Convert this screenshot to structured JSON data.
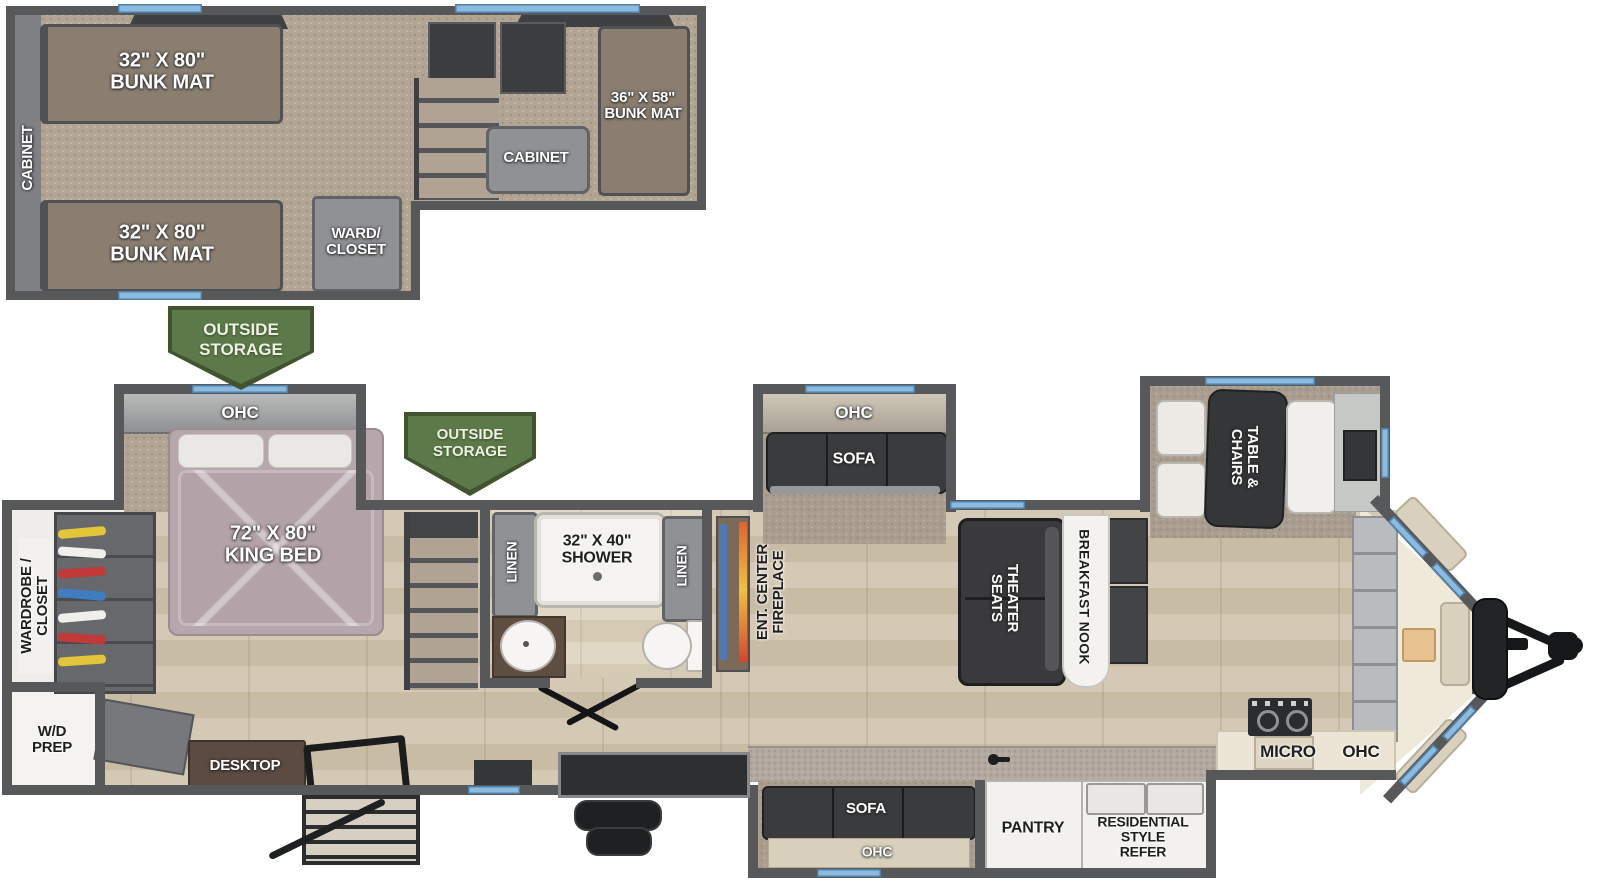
{
  "plan_title": "Travel trailer floor plan",
  "loft": {
    "side_cabinet": "CABINET",
    "bunk_top": "32\" X 80\"\nBUNK MAT",
    "bunk_bottom": "32\" X 80\"\nBUNK MAT",
    "ward_closet": "WARD/\nCLOSET",
    "cabinet": "CABINET",
    "bunk_right": "36\" X 58\"\nBUNK MAT"
  },
  "banners": {
    "storage_rear": "OUTSIDE\nSTORAGE",
    "storage_mid": "OUTSIDE\nSTORAGE"
  },
  "bedroom": {
    "ohc": "OHC",
    "king_bed": "72\" X 80\"\nKING BED",
    "wardrobe": "WARDROBE /\nCLOSET",
    "wd_prep": "W/D\nPREP",
    "desktop": "DESKTOP"
  },
  "bathroom": {
    "linen_left": "LINEN",
    "shower": "32\" X 40\"\nSHOWER",
    "linen_right": "LINEN"
  },
  "living": {
    "ent_center": "ENT. CENTER\nFIREPLACE",
    "sofa_ohc": "OHC",
    "sofa": "SOFA",
    "theater": "THEATER\nSEATS",
    "nook": "BREAKFAST NOOK",
    "dinette": "TABLE &\nCHAIRS"
  },
  "kitchen": {
    "micro": "MICRO",
    "ohc": "OHC",
    "sofa": "SOFA",
    "sofa_ohc": "OHC",
    "pantry": "PANTRY",
    "refer": "RESIDENTIAL\nSTYLE\nREFER"
  },
  "colors": {
    "wall": "#57585a",
    "window_blue": "#8cbbdf",
    "banner_green": "#5c7a49",
    "wood_floor": "#cfc4af",
    "carpet": "#b2a493",
    "bunk_mat": "#8a7e70",
    "bed": "#b5a7ac",
    "dark_furniture": "#3a3b3d",
    "granite_counter": "#b3a8a0",
    "cream_counter": "#ece5d5",
    "fixture_white": "#f2f1ed"
  }
}
